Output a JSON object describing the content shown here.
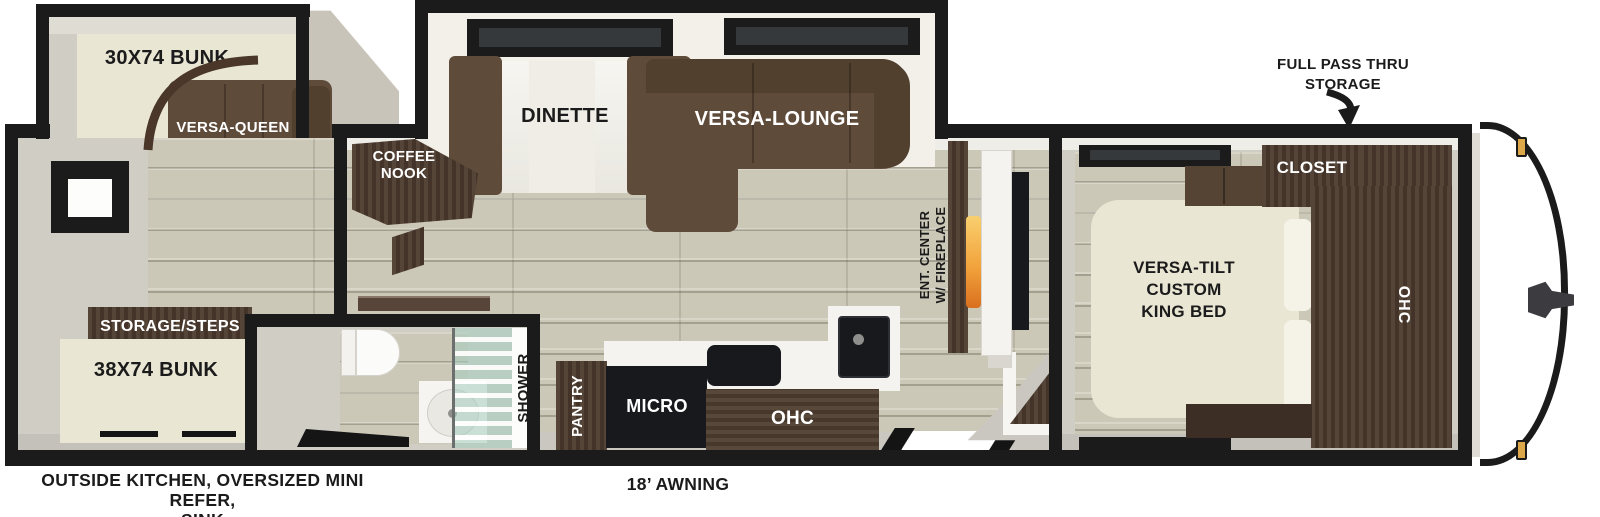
{
  "labels": {
    "bunk_top": "30X74 BUNK",
    "versa_queen": "VERSA-QUEEN",
    "coffee_nook": "COFFEE\nNOOK",
    "dinette": "DINETTE",
    "versa_lounge": "VERSA-LOUNGE",
    "full_pass_thru": "FULL PASS THRU\nSTORAGE",
    "closet": "CLOSET",
    "ent_center": "ENT. CENTER\nW/ FIREPLACE",
    "king_bed": "VERSA-TILT\nCUSTOM\nKING BED",
    "ohc_bedroom": "OHC",
    "storage_steps": "STORAGE/STEPS",
    "bunk_bottom": "38X74 BUNK",
    "shower": "SHOWER",
    "pantry": "PANTRY",
    "micro": "MICRO",
    "ohc_kitchen": "OHC",
    "outside_features": "OUTSIDE KITCHEN, OVERSIZED MINI REFER,\nSINK",
    "awning": "18’ AWNING"
  },
  "colors": {
    "wall": "#1b1b1b",
    "floor_wood": "#ccc8b7",
    "cabinet_dark": "#4c3a2d",
    "sofa_brown": "#5f4b3a",
    "mattress_cream": "#e9e6d4",
    "flame_orange": "#f2a33c",
    "marker_light": "#dca84a",
    "label_dark": "#1b1b1b",
    "label_light": "#ffffff"
  }
}
